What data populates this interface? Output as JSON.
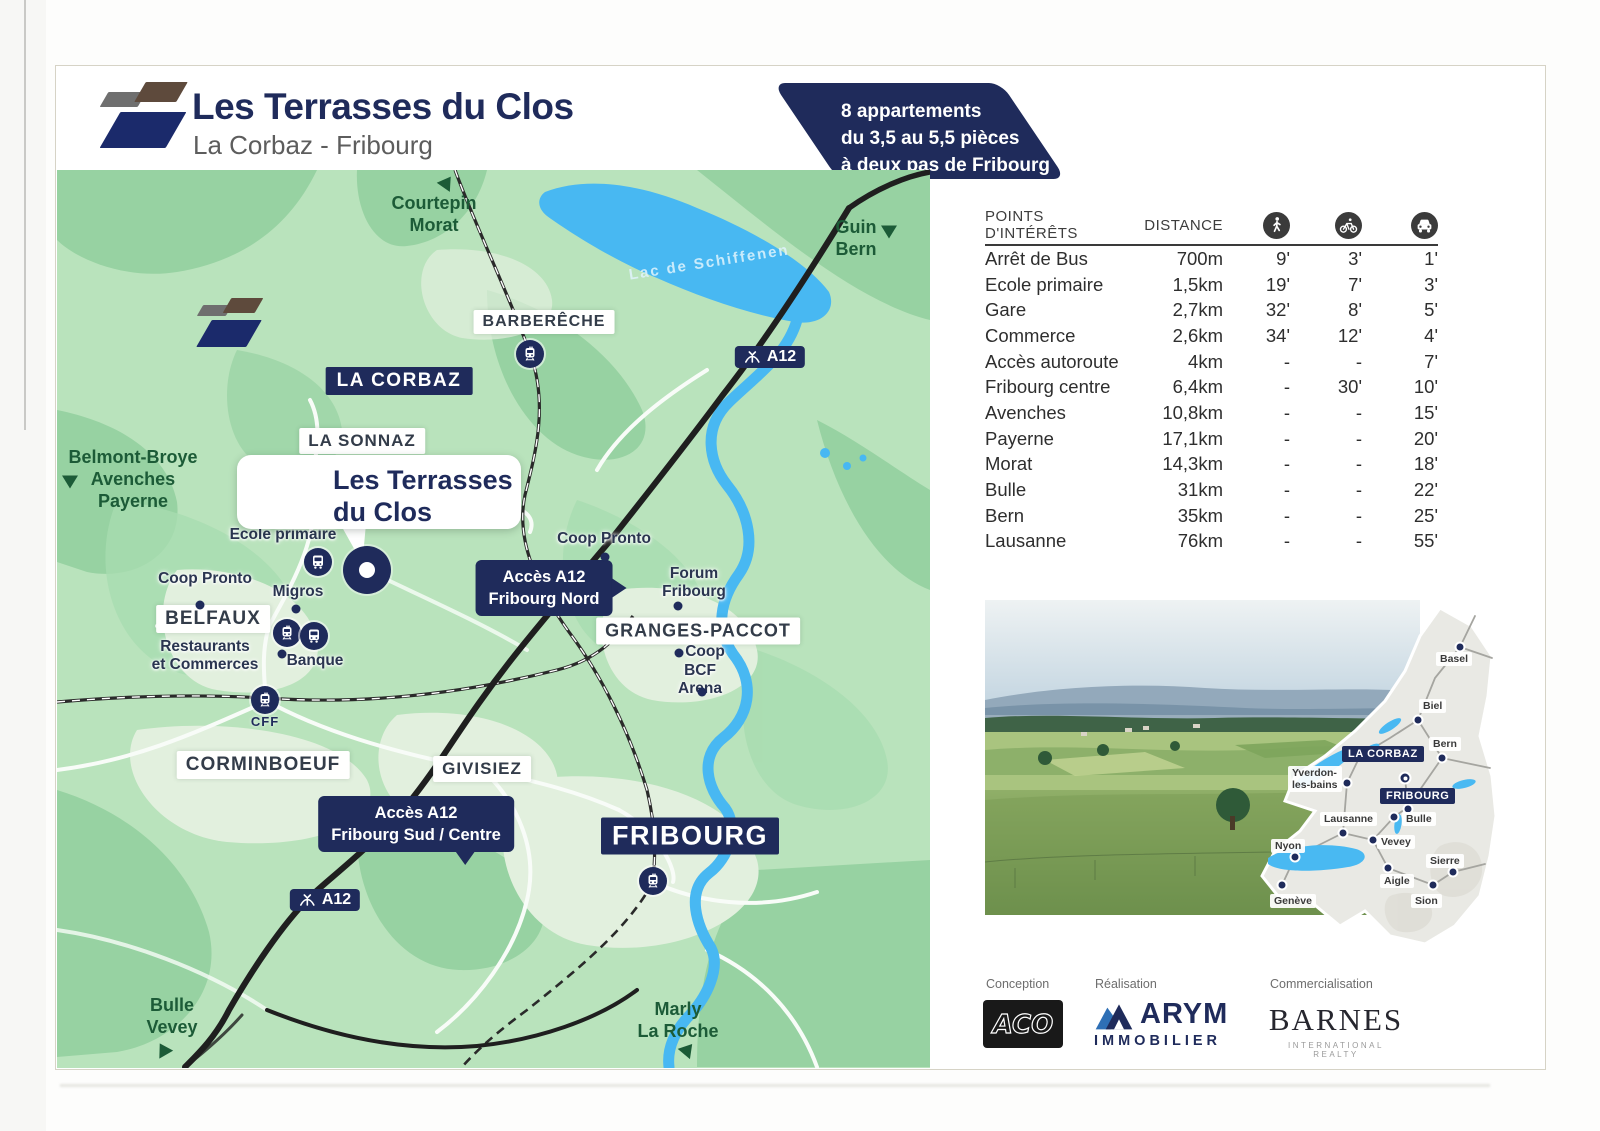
{
  "header": {
    "title": "Les Terrasses du Clos",
    "subtitle": "La Corbaz - Fribourg"
  },
  "banner": {
    "lines": [
      "8 appartements",
      "du 3,5 au 5,5 pièces",
      "à deux pas de Fribourg"
    ],
    "color": "#1f2b5b"
  },
  "map": {
    "lake_label": "Lac de Schiffenen",
    "site_callout": {
      "line1": "Les Terrasses",
      "line2": "du Clos"
    },
    "cff_label": "CFF",
    "direction_labels": [
      {
        "lines": [
          "Courtepin",
          "Morat"
        ],
        "x": 434,
        "y": 192,
        "ax": 447,
        "ay": 182,
        "rot": 35
      },
      {
        "lines": [
          "Guin",
          "Bern"
        ],
        "x": 856,
        "y": 216,
        "ax": 889,
        "ay": 232,
        "rot": 180
      },
      {
        "lines": [
          "Belmont-Broye",
          "Avenches",
          "Payerne"
        ],
        "x": 133,
        "y": 446,
        "ax": 70,
        "ay": 482,
        "rot": 180
      },
      {
        "lines": [
          "Bulle",
          "Vevey"
        ],
        "x": 172,
        "y": 994,
        "ax": 163,
        "ay": 1049,
        "rot": -30
      },
      {
        "lines": [
          "Marly",
          "La Roche"
        ],
        "x": 678,
        "y": 998,
        "ax": 688,
        "ay": 1049,
        "rot": 40
      }
    ],
    "white_labels": [
      {
        "text": "BARBERÊCHE",
        "x": 544,
        "y": 322,
        "fs": 16
      },
      {
        "text": "LA SONNAZ",
        "x": 362,
        "y": 441,
        "fs": 17
      },
      {
        "text": "BELFAUX",
        "x": 213,
        "y": 619,
        "fs": 19
      },
      {
        "text": "CORMINBOEUF",
        "x": 263,
        "y": 765,
        "fs": 19
      },
      {
        "text": "GIVISIEZ",
        "x": 482,
        "y": 769,
        "fs": 17
      },
      {
        "text": "GRANGES-PACCOT",
        "x": 698,
        "y": 631,
        "fs": 18
      }
    ],
    "navy_labels": [
      {
        "text": "LA CORBAZ",
        "x": 399,
        "y": 381,
        "fs": 19
      },
      {
        "text": "FRIBOURG",
        "x": 690,
        "y": 836,
        "fs": 27
      }
    ],
    "a12_badge_text": "A12",
    "a12_badges": [
      {
        "x": 770,
        "y": 357
      },
      {
        "x": 325,
        "y": 900
      }
    ],
    "access_callouts": [
      {
        "lines": [
          "Accès A12",
          "Fribourg Nord"
        ],
        "x": 544,
        "y": 588,
        "pointer": "right"
      },
      {
        "lines": [
          "Accès A12",
          "Fribourg Sud / Centre"
        ],
        "x": 416,
        "y": 824,
        "pointer": "down"
      }
    ],
    "poi_labels": [
      {
        "lines": [
          "Ecole primaire"
        ],
        "x": 283,
        "y": 526,
        "dot": [
          313,
          519
        ]
      },
      {
        "lines": [
          "Coop Pronto"
        ],
        "x": 205,
        "y": 570,
        "dot": [
          200,
          605
        ]
      },
      {
        "lines": [
          "Migros"
        ],
        "x": 298,
        "y": 583,
        "dot": [
          296,
          609
        ]
      },
      {
        "lines": [
          "Restaurants",
          "et Commerces"
        ],
        "x": 205,
        "y": 638
      },
      {
        "lines": [
          "Banque"
        ],
        "x": 315,
        "y": 652,
        "dot": [
          282,
          654
        ]
      },
      {
        "lines": [
          "Coop Pronto"
        ],
        "x": 604,
        "y": 530,
        "dot": [
          605,
          557
        ]
      },
      {
        "lines": [
          "Forum",
          "Fribourg"
        ],
        "x": 694,
        "y": 565,
        "dot": [
          678,
          606
        ]
      },
      {
        "lines": [
          "Coop"
        ],
        "x": 705,
        "y": 643,
        "dot": [
          679,
          653
        ]
      },
      {
        "lines": [
          "BCF",
          "Arena"
        ],
        "x": 700,
        "y": 662,
        "dot": [
          702,
          692
        ]
      }
    ],
    "transit_icons": [
      {
        "type": "bus",
        "x": 368,
        "y": 476
      },
      {
        "type": "bus",
        "x": 308,
        "y": 494
      },
      {
        "type": "bus",
        "x": 318,
        "y": 562
      },
      {
        "type": "train",
        "x": 287,
        "y": 633
      },
      {
        "type": "bus",
        "x": 314,
        "y": 636
      },
      {
        "type": "train",
        "x": 530,
        "y": 354
      },
      {
        "type": "train",
        "x": 265,
        "y": 700
      },
      {
        "type": "train",
        "x": 653,
        "y": 881
      }
    ]
  },
  "table": {
    "col_poi": "POINTS D'INTÉRÊTS",
    "col_distance": "DISTANCE",
    "icons": [
      "walk-icon",
      "bike-icon",
      "car-icon"
    ],
    "rows": [
      [
        "Arrêt de Bus",
        "700m",
        "9'",
        "3'",
        "1'"
      ],
      [
        "Ecole primaire",
        "1,5km",
        "19'",
        "7'",
        "3'"
      ],
      [
        "Gare",
        "2,7km",
        "32'",
        "8'",
        "5'"
      ],
      [
        "Commerce",
        "2,6km",
        "34'",
        "12'",
        "4'"
      ],
      [
        "Accès autoroute",
        "4km",
        "-",
        "-",
        "7'"
      ],
      [
        "Fribourg centre",
        "6,4km",
        "-",
        "30'",
        "10'"
      ],
      [
        "Avenches",
        "10,8km",
        "-",
        "-",
        "15'"
      ],
      [
        "Payerne",
        "17,1km",
        "-",
        "-",
        "20'"
      ],
      [
        "Morat",
        "14,3km",
        "-",
        "-",
        "18'"
      ],
      [
        "Bulle",
        "31km",
        "-",
        "-",
        "22'"
      ],
      [
        "Bern",
        "35km",
        "-",
        "-",
        "25'"
      ],
      [
        "Lausanne",
        "76km",
        "-",
        "-",
        "55'"
      ]
    ]
  },
  "inset": {
    "cities": [
      {
        "name": "Basel",
        "lx": 196,
        "ly": 56,
        "dx": 220,
        "dy": 51
      },
      {
        "name": "Biel",
        "lx": 179,
        "ly": 103,
        "dx": 178,
        "dy": 124
      },
      {
        "name": "Bern",
        "lx": 189,
        "ly": 141,
        "dx": 202,
        "dy": 162
      },
      {
        "name": "LA CORBAZ",
        "navy": true,
        "lx": 102,
        "ly": 150,
        "dx": 165,
        "dy": 182,
        "site": true
      },
      {
        "name": "Yverdon-",
        "name2": "les-bains",
        "lx": 48,
        "ly": 170,
        "dx": 107,
        "dy": 187
      },
      {
        "name": "FRIBOURG",
        "navy": true,
        "lx": 140,
        "ly": 192,
        "dx": 168,
        "dy": 213
      },
      {
        "name": "Lausanne",
        "lx": 80,
        "ly": 216,
        "dx": 103,
        "dy": 237
      },
      {
        "name": "Bulle",
        "lx": 162,
        "ly": 216,
        "dx": 154,
        "dy": 221
      },
      {
        "name": "Nyon",
        "lx": 31,
        "ly": 243,
        "dx": 55,
        "dy": 261
      },
      {
        "name": "Vevey",
        "lx": 137,
        "ly": 239,
        "dx": 133,
        "dy": 244
      },
      {
        "name": "Aigle",
        "lx": 140,
        "ly": 278,
        "dx": 148,
        "dy": 272
      },
      {
        "name": "Sierre",
        "lx": 186,
        "ly": 258,
        "dx": 213,
        "dy": 276
      },
      {
        "name": "Sion",
        "lx": 171,
        "ly": 298,
        "dx": 193,
        "dy": 289
      },
      {
        "name": "Genève",
        "lx": 30,
        "ly": 298,
        "dx": 42,
        "dy": 289
      }
    ]
  },
  "footer": {
    "conception_label": "Conception",
    "realisation_label": "Réalisation",
    "commercialisation_label": "Commercialisation",
    "aco_text": "ACO",
    "arym_name": "ARYM",
    "arym_sub": "IMMOBILIER",
    "barnes_name": "BARNES",
    "barnes_sub": "INTERNATIONAL REALTY"
  },
  "colors": {
    "navy": "#1f2b5b",
    "map_green": "#b9e3bc",
    "water_blue": "#48b8f2",
    "direction_green": "#1c5b37"
  }
}
